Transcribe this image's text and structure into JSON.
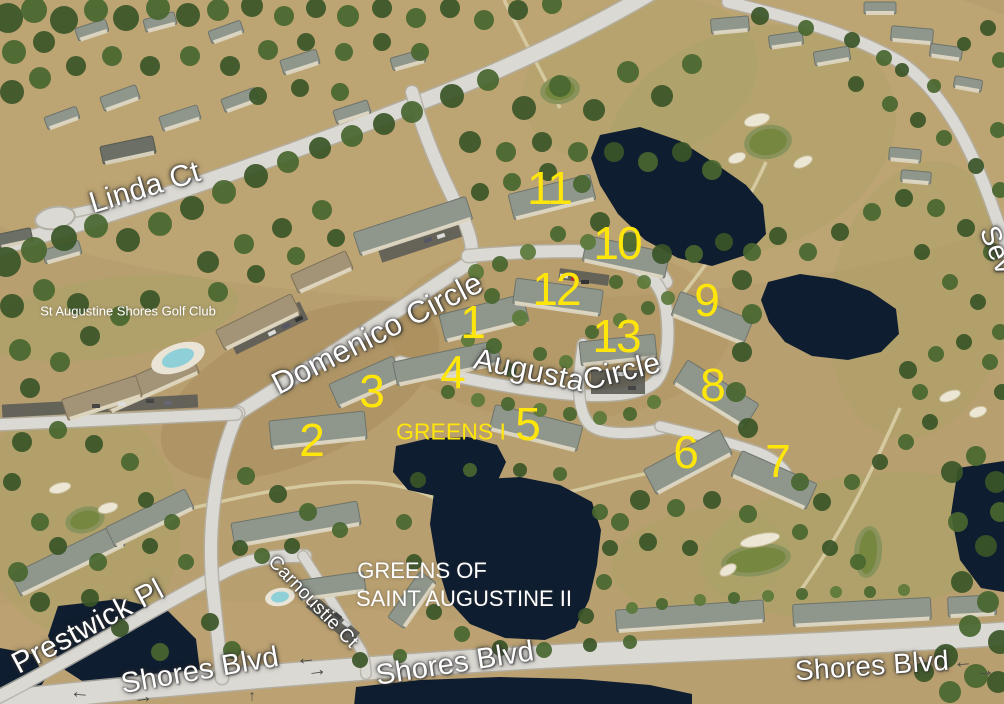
{
  "map": {
    "description": "Aerial bird's-eye view of Greens of Saint Augustine condominiums and St Augustine Shores Golf Club",
    "colors": {
      "label_yellow": "#ffe60a",
      "label_white": "#ffffff",
      "arrow_gray": "#4a4a47",
      "pond_navy": "#0f1d30",
      "road_gray": "#dbd9d3",
      "ground_tan": "#b89f6f",
      "tree_green": "#3a5527"
    },
    "street_labels": [
      {
        "name": "street-label-linda-ct",
        "text": "Linda Ct",
        "x": 145,
        "y": 188,
        "rotate": -17,
        "size": 30
      },
      {
        "name": "street-label-domenico-circle",
        "text": "Domenico Circle",
        "x": 377,
        "y": 333,
        "rotate": -27,
        "size": 31
      },
      {
        "name": "street-label-augusta",
        "text": "Augusta",
        "x": 529,
        "y": 371,
        "rotate": 12,
        "size": 30
      },
      {
        "name": "street-label-augusta-circle",
        "text": "Circle",
        "x": 622,
        "y": 372,
        "rotate": -14,
        "size": 30
      },
      {
        "name": "street-label-prestwick-pl",
        "text": "Prestwick Pl",
        "x": 88,
        "y": 627,
        "rotate": -28,
        "size": 30
      },
      {
        "name": "street-label-carnoustie-ct",
        "text": "Carnoustie Ct",
        "x": 313,
        "y": 602,
        "rotate": 46,
        "size": 19
      },
      {
        "name": "street-label-shores-blvd-left",
        "text": "Shores Blvd",
        "x": 200,
        "y": 671,
        "rotate": -10,
        "size": 29
      },
      {
        "name": "street-label-shores-blvd-mid",
        "text": "Shores Blvd",
        "x": 455,
        "y": 664,
        "rotate": -9,
        "size": 29
      },
      {
        "name": "street-label-shores-blvd-right",
        "text": "Shores Blvd",
        "x": 872,
        "y": 666,
        "rotate": -4,
        "size": 28
      },
      {
        "name": "street-label-seville-partial",
        "text": "Sev",
        "x": 997,
        "y": 250,
        "rotate": 68,
        "size": 28
      }
    ],
    "area_labels": [
      {
        "name": "area-label-golf-club",
        "text": "St Augustine Shores Golf Club",
        "x": 128,
        "y": 311,
        "rotate": 0,
        "size": 13,
        "color": "white"
      },
      {
        "name": "area-label-greens-i",
        "text": "GREENS I",
        "x": 451,
        "y": 432,
        "rotate": 0,
        "size": 23,
        "color": "yellow"
      },
      {
        "name": "area-label-greens-ii-line1",
        "text": "GREENS OF",
        "x": 422,
        "y": 571,
        "rotate": 0,
        "size": 22,
        "color": "white"
      },
      {
        "name": "area-label-greens-ii-line2",
        "text": "SAINT AUGUSTINE II",
        "x": 464,
        "y": 599,
        "rotate": 0,
        "size": 22,
        "color": "white"
      }
    ],
    "building_numbers": [
      {
        "name": "building-number-1",
        "text": "1",
        "x": 472,
        "y": 322
      },
      {
        "name": "building-number-2",
        "text": "2",
        "x": 311,
        "y": 440
      },
      {
        "name": "building-number-3",
        "text": "3",
        "x": 371,
        "y": 391
      },
      {
        "name": "building-number-4",
        "text": "4",
        "x": 452,
        "y": 372
      },
      {
        "name": "building-number-5",
        "text": "5",
        "x": 527,
        "y": 424
      },
      {
        "name": "building-number-6",
        "text": "6",
        "x": 685,
        "y": 452
      },
      {
        "name": "building-number-7",
        "text": "7",
        "x": 777,
        "y": 461
      },
      {
        "name": "building-number-8",
        "text": "8",
        "x": 712,
        "y": 385
      },
      {
        "name": "building-number-9",
        "text": "9",
        "x": 706,
        "y": 300
      },
      {
        "name": "building-number-10",
        "text": "10",
        "x": 617,
        "y": 243
      },
      {
        "name": "building-number-11",
        "text": "11",
        "x": 549,
        "y": 188
      },
      {
        "name": "building-number-12",
        "text": "12",
        "x": 556,
        "y": 289
      },
      {
        "name": "building-number-13",
        "text": "13",
        "x": 616,
        "y": 336
      }
    ],
    "traffic_arrows": [
      {
        "name": "road-arrow-left-icon",
        "glyph": "←",
        "x": 80,
        "y": 692,
        "rotate": 5,
        "size": 20
      },
      {
        "name": "road-arrow-right-icon",
        "glyph": "→",
        "x": 143,
        "y": 697,
        "rotate": -8,
        "size": 20
      },
      {
        "name": "road-arrow-left-icon",
        "glyph": "←",
        "x": 306,
        "y": 658,
        "rotate": -6,
        "size": 20
      },
      {
        "name": "road-arrow-right-icon",
        "glyph": "→",
        "x": 317,
        "y": 670,
        "rotate": -8,
        "size": 20
      },
      {
        "name": "road-arrow-up-icon",
        "glyph": "↑",
        "x": 252,
        "y": 696,
        "rotate": 0,
        "size": 15
      },
      {
        "name": "road-arrow-left-icon",
        "glyph": "←",
        "x": 963,
        "y": 662,
        "rotate": -5,
        "size": 19
      },
      {
        "name": "road-arrow-right-icon",
        "glyph": "→",
        "x": 985,
        "y": 671,
        "rotate": -5,
        "size": 19
      }
    ]
  }
}
